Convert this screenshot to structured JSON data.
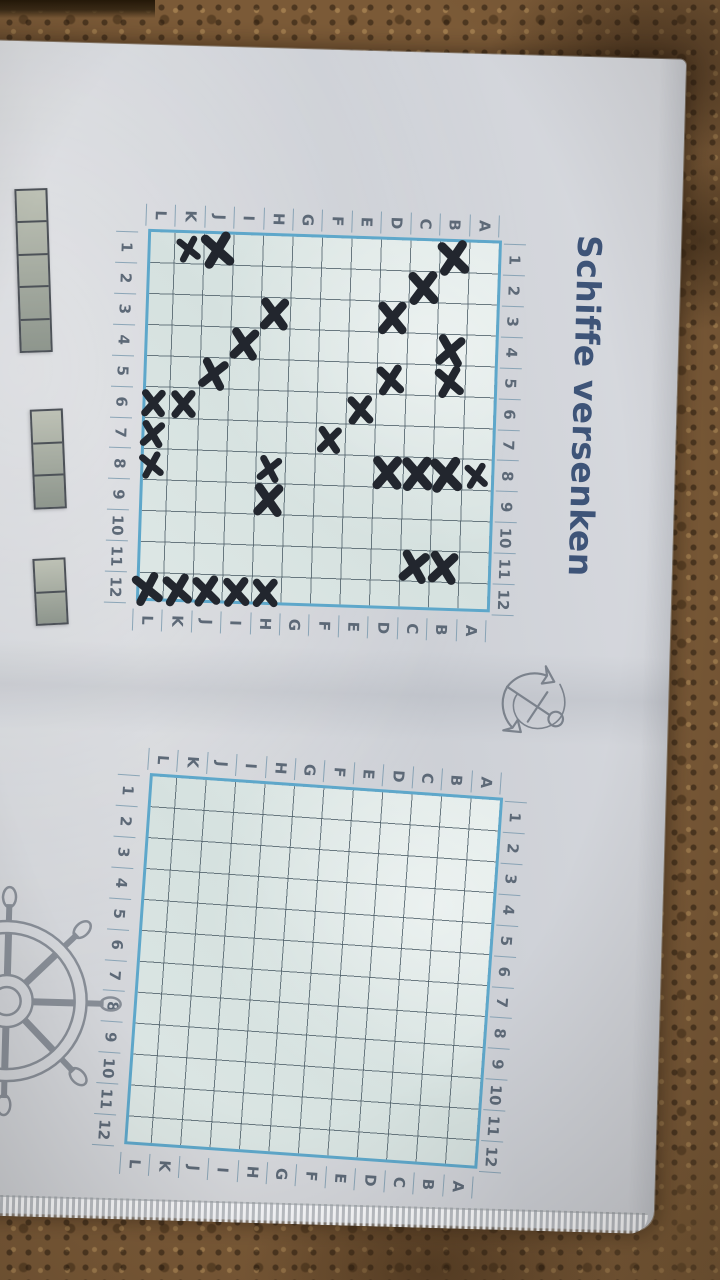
{
  "title": "Schiffe versenken",
  "grid": {
    "column_labels": [
      "1",
      "2",
      "3",
      "4",
      "5",
      "6",
      "7",
      "8",
      "9",
      "10",
      "11",
      "12"
    ],
    "row_labels": [
      "A",
      "B",
      "C",
      "D",
      "E",
      "F",
      "G",
      "H",
      "I",
      "J",
      "K",
      "L"
    ]
  },
  "left_board": {
    "name": "board-with-hit-marks",
    "marks": [
      "K1",
      "J1",
      "B1",
      "C2",
      "D3",
      "H3",
      "I4",
      "B4",
      "J5",
      "B5",
      "D5",
      "E6",
      "K6",
      "L6",
      "F7",
      "L7",
      "H8",
      "L8",
      "A8",
      "B8",
      "C8",
      "D8",
      "H9",
      "B11",
      "C11",
      "L12",
      "K12",
      "J12",
      "I12",
      "H12"
    ]
  },
  "right_board": {
    "name": "empty-board",
    "marks": []
  },
  "fleet": {
    "ship_sizes": [
      5,
      3,
      2
    ]
  },
  "icons": {
    "anchor": "anchor-icon",
    "wheel": "ship-wheel-icon"
  },
  "colors": {
    "frame_blue": "#5ea7ca",
    "grid_line": "#5b6a74",
    "mark_ink": "#22262e",
    "title_blue": "#3e5478",
    "label_gray": "#5d6977",
    "paper": "#d2d5da",
    "carpet_brown": "#7b5a37",
    "ship_fill": "#a8ad9f"
  }
}
